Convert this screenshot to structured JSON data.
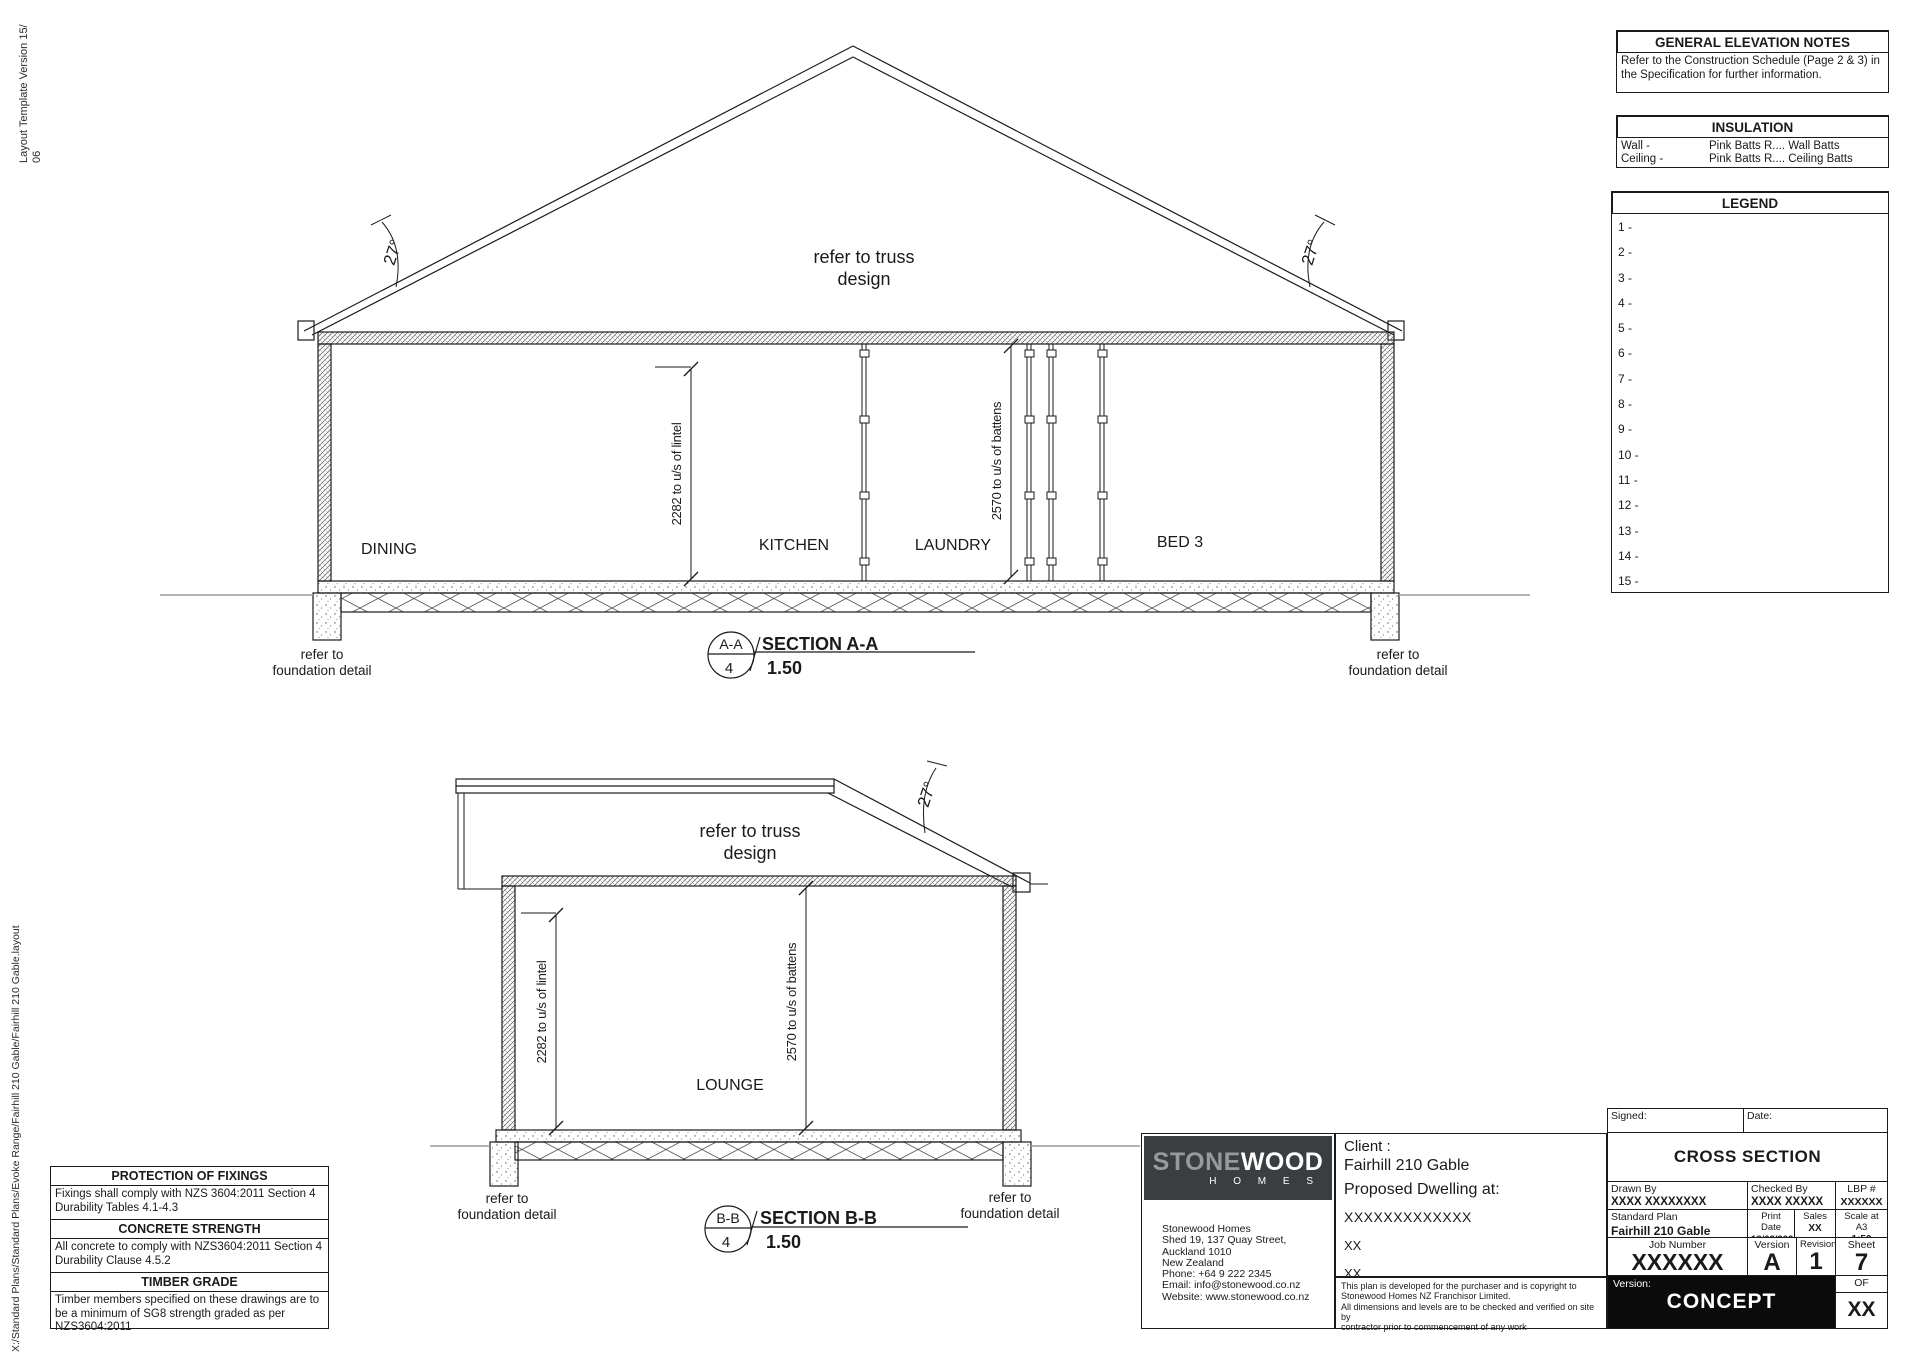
{
  "meta": {
    "side_note_top": "Layout Template Version 15/\n06",
    "side_note_bottom": "X:/Standard Plans/Standard Plans/Evoke Range/Fairhill 210 Gable/Fairhill 210 Gable.layout"
  },
  "panels": {
    "general_notes": {
      "title": "GENERAL ELEVATION NOTES",
      "body": "Refer to the Construction Schedule (Page 2 & 3) in the Specification for further information."
    },
    "insulation": {
      "title": "INSULATION",
      "rows": [
        {
          "label": "Wall -",
          "value": "Pink Batts R.... Wall Batts"
        },
        {
          "label": "Ceiling -",
          "value": "Pink Batts R.... Ceiling Batts"
        }
      ]
    },
    "legend": {
      "title": "LEGEND",
      "items": [
        "1 -",
        "2 -",
        "3 -",
        "4 -",
        "5 -",
        "6 -",
        "7 -",
        "8 -",
        "9 -",
        "10 -",
        "11 -",
        "12 -",
        "13 -",
        "14 -",
        "15 -"
      ]
    }
  },
  "notes_left": {
    "sections": [
      {
        "title": "PROTECTION OF FIXINGS",
        "body": "Fixings shall comply with NZS 3604:2011 Section 4 Durability Tables 4.1-4.3"
      },
      {
        "title": "CONCRETE STRENGTH",
        "body": "All concrete to comply with NZS3604:2011 Section 4 Durability Clause 4.5.2"
      },
      {
        "title": "TIMBER GRADE",
        "body": "Timber members specified on these drawings are to be a minimum of SG8 strength graded as per NZS3604:2011"
      }
    ]
  },
  "drawing": {
    "angle": "27°",
    "truss_note_1": "refer to truss",
    "truss_note_2": "design",
    "dim_lintel": "2282 to u/s of lintel",
    "dim_battens": "2570 to u/s of battens",
    "foundation_1": "refer to",
    "foundation_2": "foundation detail",
    "section_a": {
      "ref": "A-A",
      "sheet": "4",
      "title": "SECTION A-A",
      "scale": "1.50",
      "rooms": [
        "DINING",
        "KITCHEN",
        "LAUNDRY",
        "BED 3"
      ]
    },
    "section_b": {
      "ref": "B-B",
      "sheet": "4",
      "title": "SECTION B-B",
      "scale": "1.50",
      "room": "LOUNGE"
    }
  },
  "titleblock": {
    "logo": {
      "brand_1": "STONE",
      "brand_2": "WOOD",
      "sub": "H O M E S"
    },
    "address": [
      "Stonewood Homes",
      "Shed 19, 137 Quay Street,",
      "Auckland 1010",
      "New Zealand",
      "Phone: +64 9 222 2345",
      "Email: info@stonewood.co.nz",
      "Website: www.stonewood.co.nz"
    ],
    "client_label": "Client :",
    "client_name": "Fairhill 210 Gable",
    "client_sub": "Proposed Dwelling at:",
    "client_lines": [
      "XXXXXXXXXXXXX",
      "XX",
      "XX"
    ],
    "disclaimer": "This plan is developed for the purchaser and is copyright to\nStonewood Homes NZ Franchisor Limited.\nAll dimensions and levels are to be checked and verified on site by\ncontractor prior to commencement of any work",
    "signed_label": "Signed:",
    "date_label": "Date:",
    "sheet_title": "CROSS SECTION",
    "drawn_by": {
      "label": "Drawn By",
      "value": "XXXX XXXXXXXX"
    },
    "checked_by": {
      "label": "Checked By",
      "value": "XXXX XXXXX"
    },
    "lbp": {
      "label": "LBP #",
      "value": "XXXXXX"
    },
    "standard_plan": {
      "label": "Standard Plan",
      "value": "Fairhill 210 Gable"
    },
    "print_date": {
      "label": "Print Date",
      "value": "18/08/2020"
    },
    "sales": {
      "label": "Sales",
      "value": "XX"
    },
    "scale": {
      "label": "Scale at A3",
      "value": "1:50"
    },
    "job_number": {
      "label": "Job Number",
      "value": "XXXXXX"
    },
    "version": {
      "label": "Version",
      "value": "A"
    },
    "revision": {
      "label": "Revision",
      "value": "1"
    },
    "sheet": {
      "label": "Sheet",
      "value": "7"
    },
    "version_banner": {
      "label": "Version:",
      "value": "CONCEPT"
    },
    "of": {
      "label": "OF",
      "value": "XX"
    }
  },
  "colors": {
    "line": "#1a1a1a",
    "logo_bg": "#3a3e40",
    "logo_stone": "#97999b",
    "logo_wood": "#ffffff",
    "banner_bg": "#0b0b0b"
  }
}
